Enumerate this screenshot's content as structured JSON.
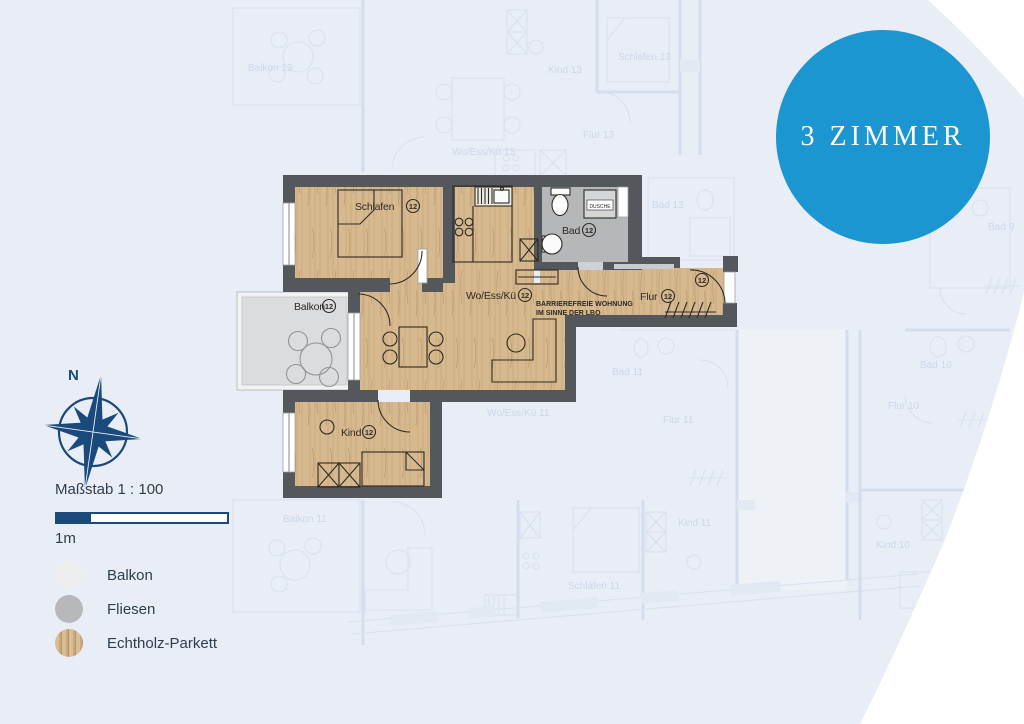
{
  "badge": {
    "label": "3 ZIMMER",
    "color": "#1c96d0"
  },
  "compass": {
    "north_label": "N",
    "color": "#1a4a7c"
  },
  "scale": {
    "caption": "Maßstab 1 : 100",
    "unit_label": "1m",
    "filled_fraction": 0.2
  },
  "legend": {
    "items": [
      {
        "label": "Balkon",
        "swatch": "balcony",
        "color": "#edefef"
      },
      {
        "label": "Fliesen",
        "swatch": "tiles",
        "color": "#b6b8ba"
      },
      {
        "label": "Echtholz-Parkett",
        "swatch": "parquet",
        "color": "#d7b98f"
      }
    ]
  },
  "plan": {
    "unit_number": "12",
    "rooms": [
      {
        "id": "schlafen",
        "label": "Schlafen",
        "unit": "12"
      },
      {
        "id": "bad",
        "label": "Bad",
        "unit": "12"
      },
      {
        "id": "woessku",
        "label": "Wo/Ess/Kü",
        "unit": "12"
      },
      {
        "id": "flur",
        "label": "Flur",
        "unit": "12"
      },
      {
        "id": "kind",
        "label": "Kind",
        "unit": "12"
      },
      {
        "id": "balkon",
        "label": "Balkon",
        "unit": "12"
      }
    ],
    "shower_label": "DUSCHE",
    "entrance_unit": "12",
    "note_line1": "BARRIEREFREIE WOHNUNG",
    "note_line2": "IM SINNE DER LBO",
    "colors": {
      "wall": "#54585d",
      "wood": "#d7b98f",
      "tiles": "#b5b7b9",
      "balcony": "#dadcdd"
    }
  },
  "background": {
    "labels": [
      {
        "text": "Balkon 13"
      },
      {
        "text": "Kind 13"
      },
      {
        "text": "Schlafen 13"
      },
      {
        "text": "Wo/Ess/Kü 13"
      },
      {
        "text": "Flur 13"
      },
      {
        "text": "Bad 13"
      },
      {
        "text": "Bad 9"
      },
      {
        "text": "Bad 11"
      },
      {
        "text": "Flur 11"
      },
      {
        "text": "Wo/Ess/Kü 11"
      },
      {
        "text": "Balkon 11"
      },
      {
        "text": "Schlafen 11"
      },
      {
        "text": "Kind 11"
      },
      {
        "text": "Bad 10"
      },
      {
        "text": "Flur 10"
      },
      {
        "text": "Schlafen 10"
      },
      {
        "text": "Kind 10"
      }
    ]
  }
}
